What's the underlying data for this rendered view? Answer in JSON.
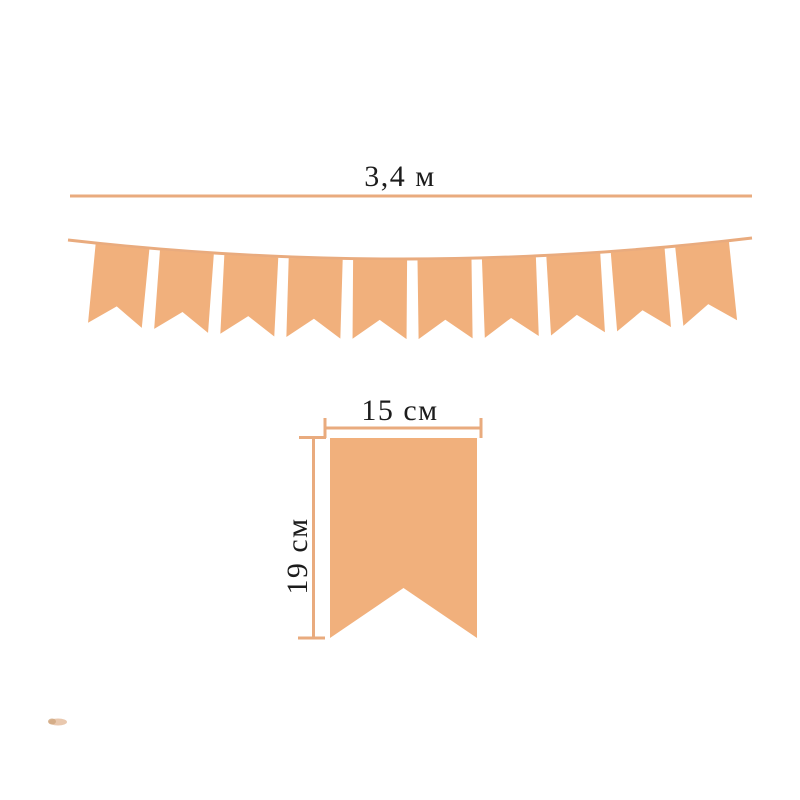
{
  "colors": {
    "background": "#ffffff",
    "flag": "#f1b07c",
    "line": "#e9ab7e",
    "text": "#1c1c1c",
    "smudge": "#ddab82"
  },
  "garland": {
    "length_label": "3,4 м",
    "flag_count": 10
  },
  "single_flag": {
    "width_label": "15 см",
    "height_label": "19 см"
  }
}
